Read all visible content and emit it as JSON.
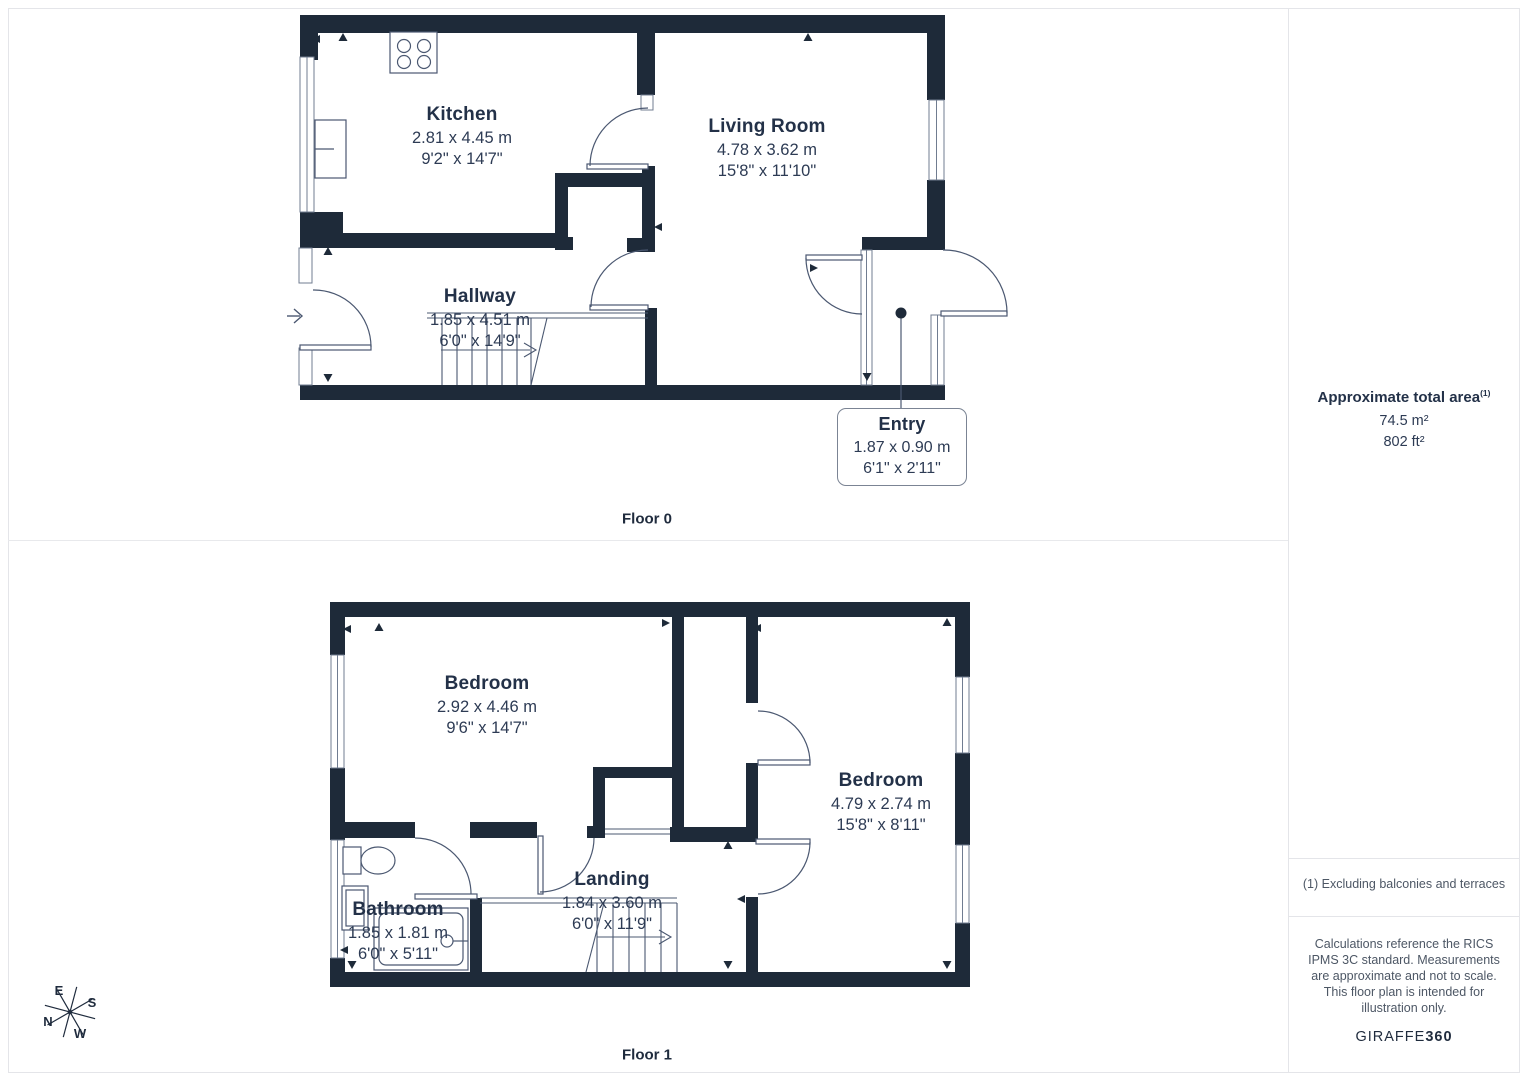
{
  "colors": {
    "wall": "#1e2a39",
    "text": "#24324a",
    "thin_line": "#4b5871",
    "window_line": "#707c90",
    "panel_border": "#e4e5e9",
    "muted_text": "#4d5765"
  },
  "floors": [
    {
      "label": "Floor 0",
      "rooms": [
        {
          "name": "Kitchen",
          "metric": "2.81 x 4.45 m",
          "imperial": "9'2\" x 14'7\""
        },
        {
          "name": "Living Room",
          "metric": "4.78 x 3.62 m",
          "imperial": "15'8\" x 11'10\""
        },
        {
          "name": "Hallway",
          "metric": "1.85 x 4.51 m",
          "imperial": "6'0\" x 14'9\""
        },
        {
          "name": "Entry",
          "metric": "1.87 x 0.90 m",
          "imperial": "6'1\" x 2'11\""
        }
      ]
    },
    {
      "label": "Floor 1",
      "rooms": [
        {
          "name": "Bedroom",
          "metric": "2.92 x 4.46 m",
          "imperial": "9'6\" x 14'7\""
        },
        {
          "name": "Bedroom",
          "metric": "4.79 x 2.74 m",
          "imperial": "15'8\" x 8'11\""
        },
        {
          "name": "Bathroom",
          "metric": "1.85 x 1.81 m",
          "imperial": "6'0\" x 5'11\""
        },
        {
          "name": "Landing",
          "metric": "1.84 x 3.60 m",
          "imperial": "6'0\" x 11'9\""
        }
      ]
    }
  ],
  "sidebar": {
    "title": "Approximate total area",
    "title_superscript": "(1)",
    "area_metric": "74.5 m²",
    "area_imperial": "802 ft²",
    "footnote": "(1) Excluding balconies and terraces",
    "disclaimer": "Calculations reference the RICS IPMS 3C standard. Measurements are approximate and not to scale. This floor plan is intended for illustration only.",
    "brand_name": "GIRAFFE",
    "brand_suffix": "360"
  },
  "compass": {
    "north": "N",
    "east": "E",
    "south": "S",
    "west": "W"
  }
}
